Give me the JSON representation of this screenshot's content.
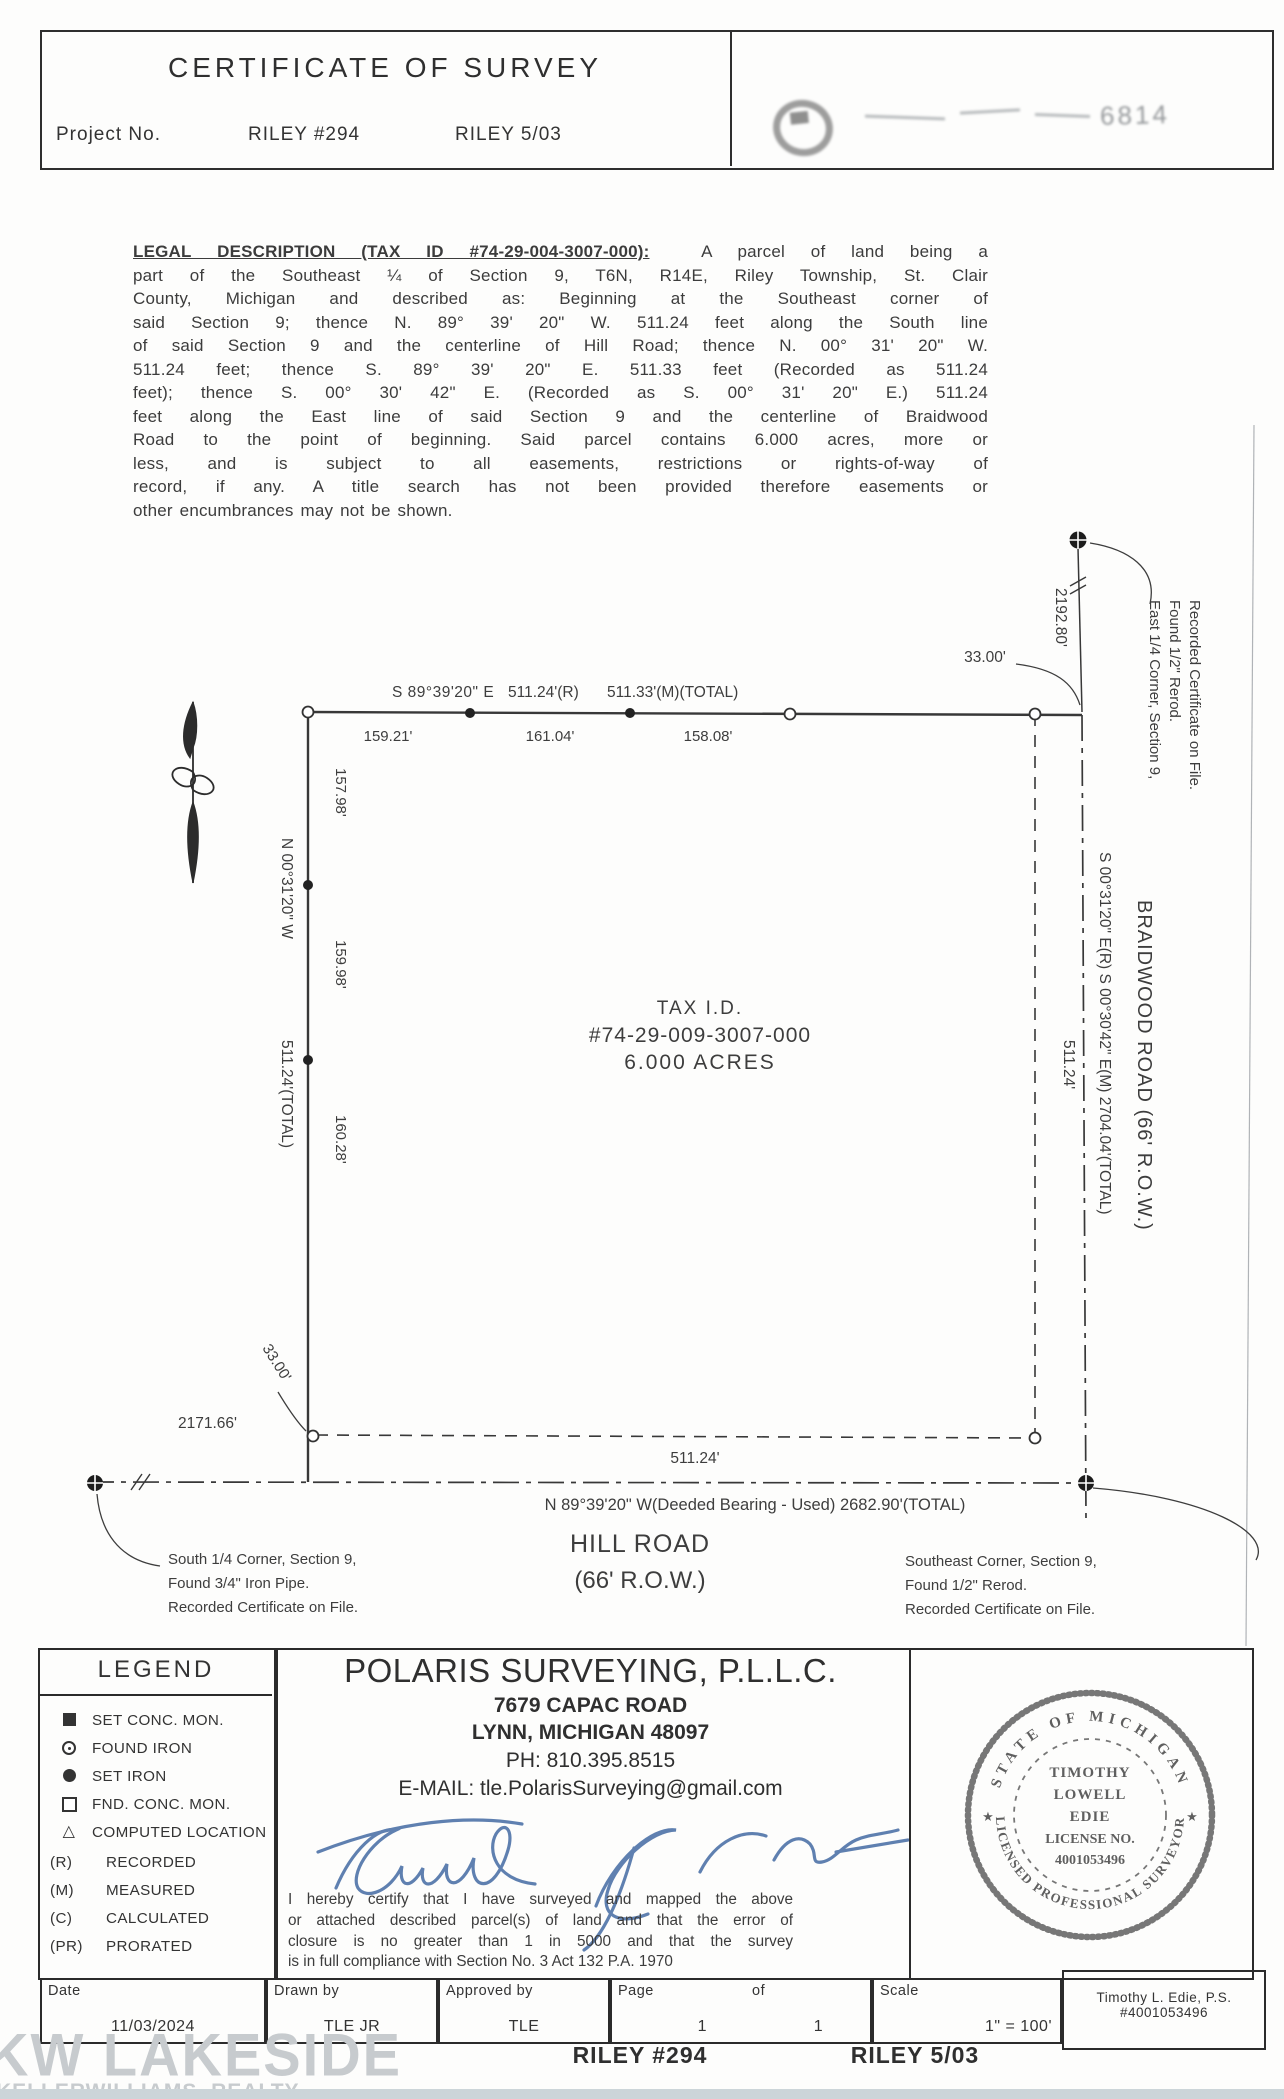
{
  "header": {
    "title": "CERTIFICATE OF SURVEY",
    "project_label": "Project No.",
    "project_number": "RILEY #294",
    "project_date": "RILEY 5/03",
    "stamp_visible_text": "6814"
  },
  "legal": {
    "heading": "LEGAL DESCRIPTION (TAX ID #74-29-004-3007-000):",
    "line1_rest": "A parcel of land being a",
    "lines": [
      "part of the Southeast ¼ of Section 9, T6N, R14E, Riley Township, St. Clair",
      "County, Michigan and described as: Beginning at the Southeast corner of",
      "said Section 9; thence N. 89° 39' 20\" W. 511.24 feet along the South line",
      "of said Section 9 and the centerline of Hill Road; thence N. 00° 31' 20\" W.",
      "511.24 feet; thence S. 89° 39' 20\" E. 511.33 feet (Recorded as 511.24",
      "feet); thence S. 00° 30' 42\" E. (Recorded as S. 00° 31' 20\" E.) 511.24",
      "feet along the East line of said Section 9 and the centerline of Braidwood",
      "Road to the point of beginning. Said parcel contains 6.000 acres, more or",
      "less, and is subject to all easements, restrictions or rights-of-way of",
      "record, if any. A title search has not been provided therefore easements or",
      "other encumbrances may not be shown."
    ]
  },
  "drawing": {
    "north_side": {
      "bearing": "S 89°39'20\" E",
      "recorded": "511.24'(R)",
      "measured": "511.33'(M)(TOTAL)",
      "seg1": "159.21'",
      "seg2": "161.04'",
      "seg3": "158.08'",
      "offset": "33.00'"
    },
    "west_side": {
      "bearing": "N 00°31'20\" W",
      "total": "511.24'(TOTAL)",
      "seg1": "157.98'",
      "seg2": "159.98'",
      "seg3": "160.28'",
      "offset": "33.00'",
      "quarter_dim": "2171.66'"
    },
    "east_side": {
      "north_dim": "2192.80'",
      "corner_note1": "East 1/4 Corner, Section 9,",
      "corner_note2": "Found 1/2\" Rerod.",
      "corner_note3": "Recorded Certificate on File.",
      "bearings": "S 00°31'20\" E(R)   S 00°30'42\" E(M)   2704.04'(TOTAL)",
      "side_dim": "511.24'",
      "road": "BRAIDWOOD ROAD (66' R.O.W.)"
    },
    "south_side": {
      "side_dim": "511.24'",
      "bearing_total": "N 89°39'20\" W(Deeded Bearing  -  Used)   2682.90'(TOTAL)",
      "road_name": "HILL ROAD",
      "road_row": "(66' R.O.W.)",
      "sw_note1": "South 1/4 Corner, Section 9,",
      "sw_note2": "Found 3/4\" Iron Pipe.",
      "sw_note3": "Recorded Certificate on File.",
      "se_note1": "Southeast Corner, Section 9,",
      "se_note2": "Found 1/2\" Rerod.",
      "se_note3": "Recorded Certificate on File."
    },
    "parcel": {
      "tax_label": "TAX I.D.",
      "tax_id": "#74-29-009-3007-000",
      "area": "6.000 ACRES"
    }
  },
  "legend": {
    "title": "LEGEND",
    "symbols": [
      {
        "icon": "filled-square",
        "label": "SET CONC. MON."
      },
      {
        "icon": "circle-with-dot",
        "label": "FOUND IRON"
      },
      {
        "icon": "filled-circle",
        "label": "SET IRON"
      },
      {
        "icon": "open-square",
        "label": "FND. CONC. MON."
      },
      {
        "icon": "open-triangle",
        "label": "COMPUTED LOCATION"
      }
    ],
    "abbrevs": [
      {
        "code": "(R)",
        "label": "RECORDED"
      },
      {
        "code": "(M)",
        "label": "MEASURED"
      },
      {
        "code": "(C)",
        "label": "CALCULATED"
      },
      {
        "code": "(PR)",
        "label": "PRORATED"
      }
    ]
  },
  "firm": {
    "name": "POLARIS  SURVEYING, P.L.L.C.",
    "address1": "7679 CAPAC ROAD",
    "address2": "LYNN, MICHIGAN  48097",
    "phone": "PH: 810.395.8515",
    "email": "E-MAIL: tle.PolarisSurveying@gmail.com",
    "signature_name": "Timothy L. Edie",
    "certification_lines": [
      "I hereby certify that I have surveyed and mapped the above",
      "or attached described parcel(s) of land and that the error of",
      "closure is no greater than 1 in 5000 and that the survey",
      "is in full compliance with Section No. 3 Act 132 P.A. 1970"
    ]
  },
  "seal": {
    "arc_top": "STATE OF MICHIGAN",
    "arc_bottom": "LICENSED PROFESSIONAL SURVEYOR",
    "star": "★",
    "center1": "TIMOTHY",
    "center2": "LOWELL",
    "center3": "EDIE",
    "center4": "LICENSE NO.",
    "center5": "4001053496"
  },
  "title_block": {
    "date_label": "Date",
    "date": "11/03/2024",
    "drawn_label": "Drawn by",
    "drawn": "TLE JR",
    "approved_label": "Approved by",
    "approved": "TLE",
    "page_label": "Page",
    "of_label": "of",
    "page_value": "1",
    "of_value": "1",
    "scale_label": "Scale",
    "scale": "1\" = 100'",
    "surveyor": "Timothy L. Edie, P.S. #4001053496"
  },
  "footer": {
    "project": "RILEY #294",
    "date": "RILEY 5/03"
  },
  "watermark": {
    "line1": "KW LAKESIDE",
    "line2": "KELLERWILLIAMS. REALTY"
  }
}
